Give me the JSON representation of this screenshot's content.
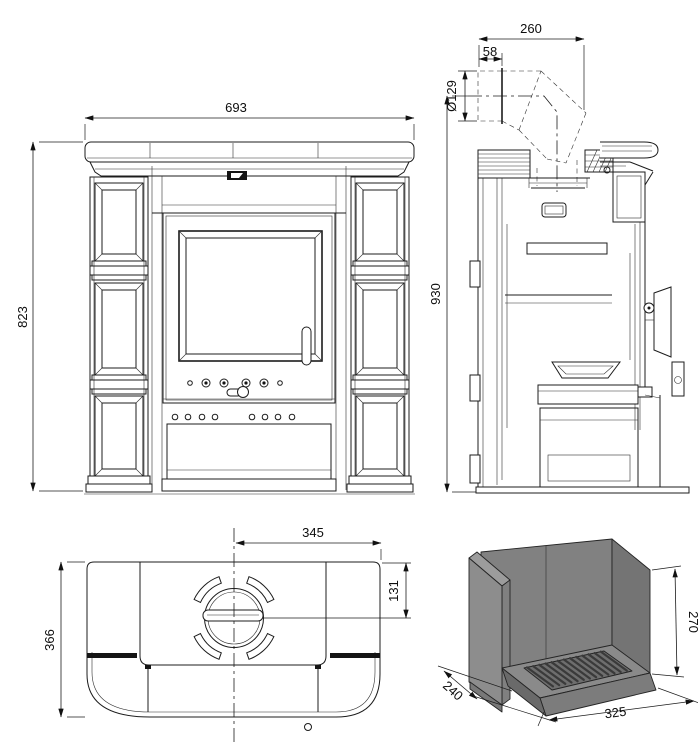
{
  "drawing": {
    "type": "stove-dimensional-drawing",
    "views": [
      "front",
      "side-section",
      "top",
      "firebox-3d"
    ]
  },
  "views": {
    "front": {
      "width": "693",
      "height": "823"
    },
    "side": {
      "flue_offset": "260",
      "flue_collar": "58",
      "flue_diameter": "Ø129",
      "height": "930"
    },
    "top": {
      "flue_center_from_right": "345",
      "flue_center_from_back": "131",
      "depth": "366"
    },
    "firebox": {
      "height": "270",
      "depth": "240",
      "width": "325"
    }
  },
  "colors": {
    "line": "#1c1c1c",
    "background": "#ffffff",
    "firebox_back": "#818181",
    "firebox_right": "#747474",
    "firebox_left": "#8d8d8d",
    "firebox_left_top": "#9c9c9c",
    "firebox_left_edge": "#808080",
    "firebox_step": "#787878",
    "tray_top": "#8a8a8a",
    "tray_front": "#7c7c7c",
    "tray_left": "#6a6a6a",
    "grate": "#6e6e6e"
  }
}
